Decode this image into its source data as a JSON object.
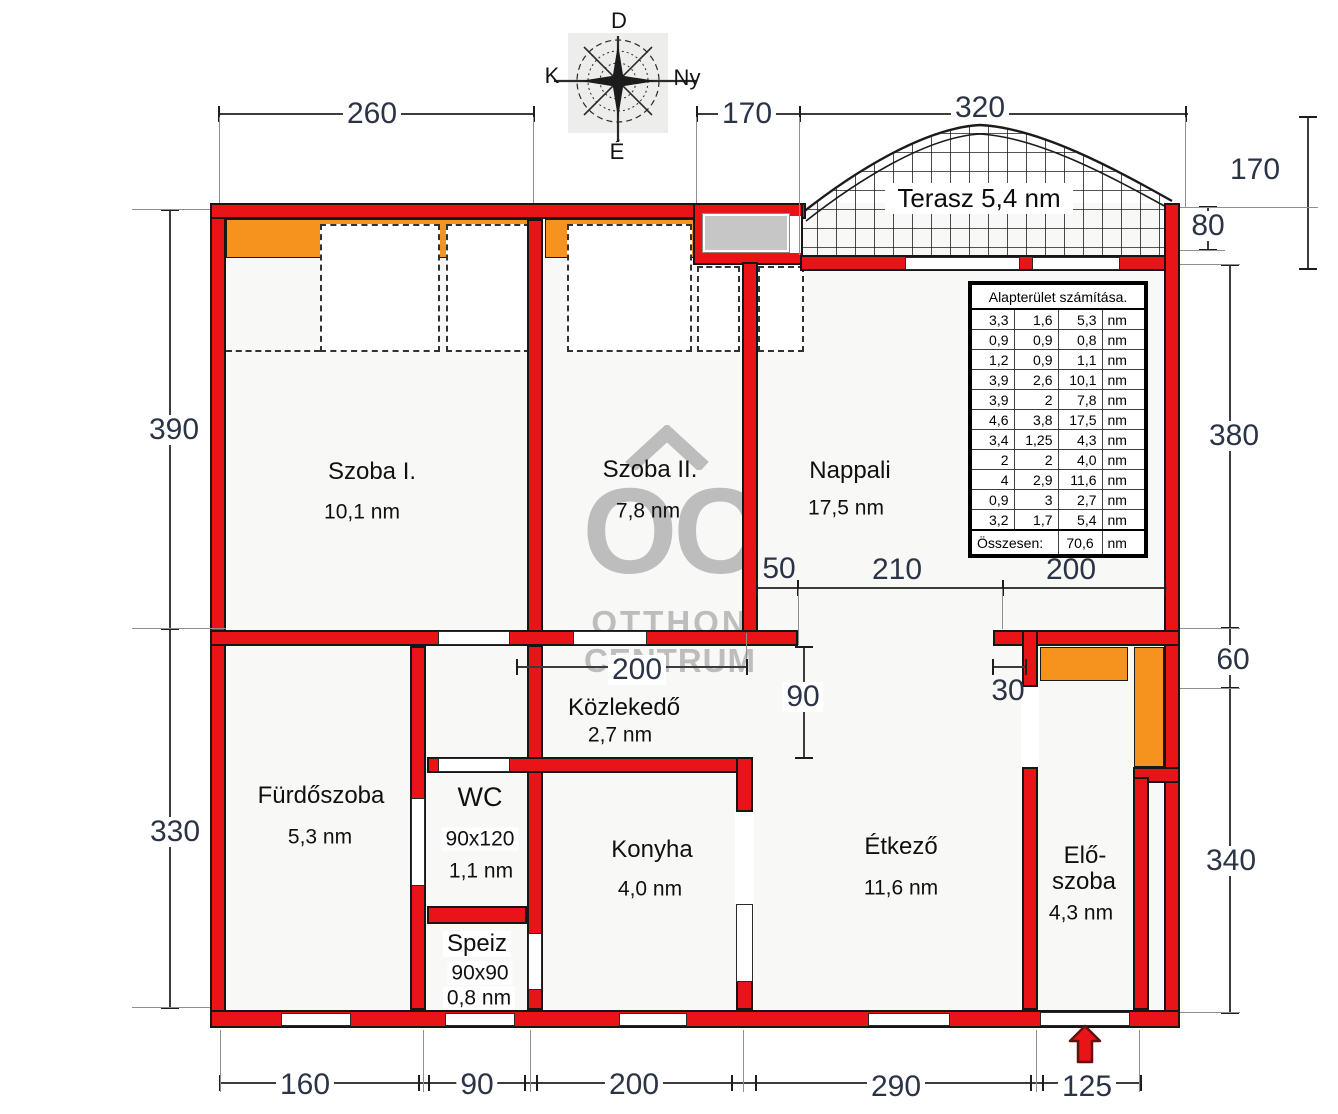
{
  "compass": {
    "top": "D",
    "left": "K",
    "right": "Ny",
    "bottom": "É"
  },
  "watermark": {
    "logo": "OC",
    "line1": "OTTHON",
    "line2": "CENTRUM"
  },
  "terrace": {
    "label": "Terasz 5,4 nm"
  },
  "rooms": {
    "szoba1": {
      "name": "Szoba I.",
      "area": "10,1 nm"
    },
    "szoba2": {
      "name": "Szoba II.",
      "area": "7,8 nm"
    },
    "nappali": {
      "name": "Nappali",
      "area": "17,5 nm"
    },
    "furdoszoba": {
      "name": "Fürdőszoba",
      "area": "5,3 nm"
    },
    "wc": {
      "name": "WC",
      "size": "90x120",
      "area": "1,1 nm"
    },
    "speiz": {
      "name": "Speiz",
      "size": "90x90",
      "area": "0,8 nm"
    },
    "konyha": {
      "name": "Konyha",
      "area": "4,0 nm"
    },
    "etkezo": {
      "name": "Étkező",
      "area": "11,6 nm"
    },
    "eloszoba": {
      "name1": "Elő-",
      "name2": "szoba",
      "area": "4,3 nm"
    },
    "kozlekedo": {
      "name": "Közlekedő",
      "area": "2,7 nm"
    }
  },
  "dimensions": {
    "top_260": "260",
    "top_170": "170",
    "top_320": "320",
    "right_170": "170",
    "right_80": "80",
    "right_380": "380",
    "right_60": "60",
    "right_340": "340",
    "left_390": "390",
    "left_330": "330",
    "bottom_160": "160",
    "bottom_90": "90",
    "bottom_200": "200",
    "bottom_290": "290",
    "bottom_125": "125",
    "inner_50": "50",
    "inner_210": "210",
    "inner_200_right": "200",
    "inner_200_hall": "200",
    "inner_90": "90",
    "inner_30": "30"
  },
  "table": {
    "title": "Alapterület számítása.",
    "unit": "nm",
    "rows": [
      [
        "3,3",
        "1,6",
        "5,3"
      ],
      [
        "0,9",
        "0,9",
        "0,8"
      ],
      [
        "1,2",
        "0,9",
        "1,1"
      ],
      [
        "3,9",
        "2,6",
        "10,1"
      ],
      [
        "3,9",
        "2",
        "7,8"
      ],
      [
        "4,6",
        "3,8",
        "17,5"
      ],
      [
        "3,4",
        "1,25",
        "4,3"
      ],
      [
        "2",
        "2",
        "4,0"
      ],
      [
        "4",
        "2,9",
        "11,6"
      ],
      [
        "0,9",
        "3",
        "2,7"
      ],
      [
        "3,2",
        "1,7",
        "5,4"
      ]
    ],
    "total_label": "Összesen:",
    "total_value": "70,6"
  },
  "colors": {
    "wall": "#e81418",
    "furniture": "#f6921e",
    "window_glass": "#c6c6c6",
    "watermark": "#bdbdbd",
    "dimension_text": "#2b3446"
  }
}
